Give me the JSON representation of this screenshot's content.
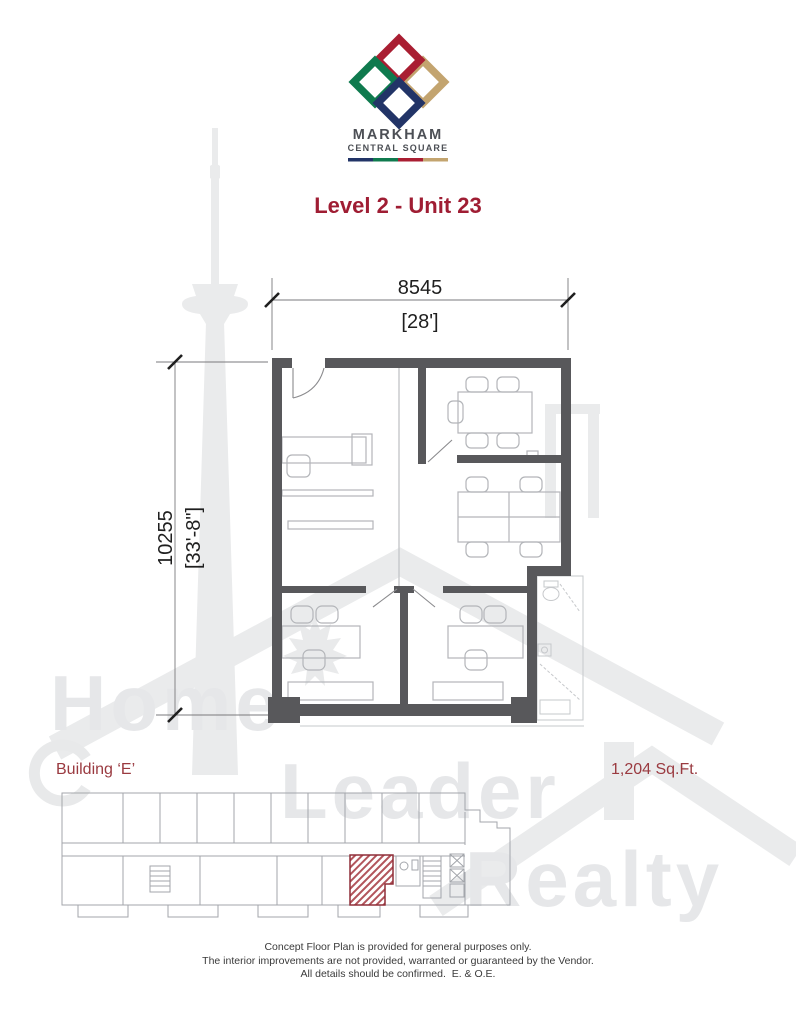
{
  "brand": {
    "name": "MARKHAM",
    "tagline": "CENTRAL SQUARE",
    "logo_colors": {
      "red": "#A91E32",
      "green": "#0F7A4E",
      "gold": "#C3A46F",
      "navy": "#223467"
    },
    "text_color": "#4C4F55"
  },
  "page_title": {
    "label": "Level 2 - Unit 23",
    "color": "#9F1D33"
  },
  "unit_plan": {
    "width_metric": "8545",
    "width_imperial": "[28']",
    "depth_metric": "10255",
    "depth_imperial": "[33'-8\"]"
  },
  "key_plan": {
    "building_label": "Building ‘E’",
    "area_label": "1,204 Sq.Ft.",
    "label_color": "#9A3A40",
    "unit_highlight_color": "#B2555C"
  },
  "watermark": {
    "words": [
      "Home",
      "Leader",
      "Realty"
    ],
    "color": "#E6E7E9"
  },
  "disclaimer": {
    "lines": [
      "Concept Floor Plan is provided for general purposes only.",
      "The interior improvements are not provided, warranted or guaranteed by the Vendor.",
      "All details should be confirmed.  E. & O.E."
    ]
  }
}
